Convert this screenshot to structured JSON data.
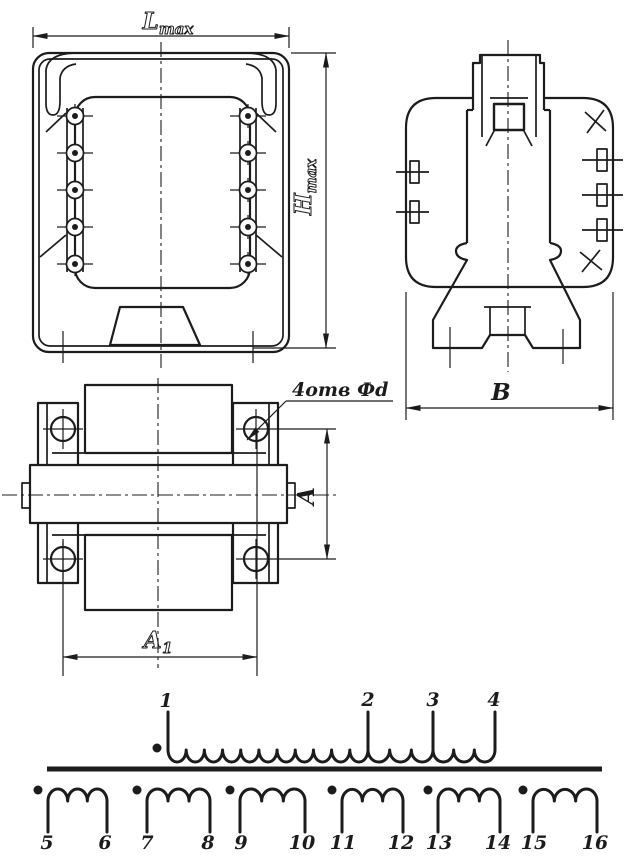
{
  "colors": {
    "ink": "#1c1c1c",
    "paper": "#ffffff"
  },
  "dimensions": {
    "lmax": {
      "base": "L",
      "sub": "max"
    },
    "hmax": {
      "base": "H",
      "sub": "max"
    },
    "width_b": "В",
    "depth_a": "А",
    "length_a1": {
      "base": "А",
      "sub": "1"
    },
    "holes_note": "4отв Фd"
  },
  "schematic": {
    "primary_terminals": [
      "1",
      "2",
      "3",
      "4"
    ],
    "secondary_terminals": [
      "5",
      "6",
      "7",
      "8",
      "9",
      "10",
      "11",
      "12",
      "13",
      "14",
      "15",
      "16"
    ]
  }
}
